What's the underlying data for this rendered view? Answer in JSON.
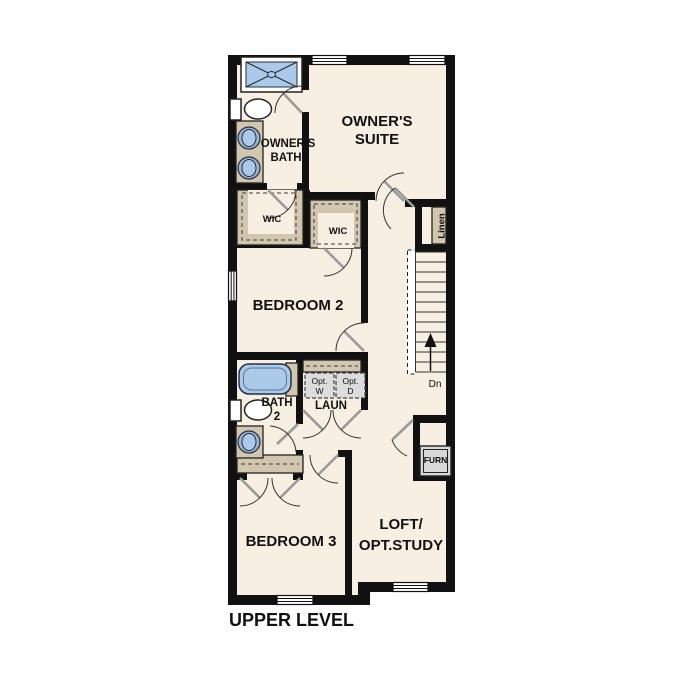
{
  "title": "UPPER LEVEL",
  "colors": {
    "background": "#ffffff",
    "floor": "#f6efe2",
    "walls": "#111111",
    "closet_tan": "#d3c6af",
    "fixture_blue": "#abc9e8",
    "appliance_gray": "#dcdcdc",
    "door_gray": "#9a9a9a"
  },
  "rooms": {
    "owners_suite": {
      "label_line1": "OWNER'S",
      "label_line2": "SUITE"
    },
    "owners_bath": {
      "label_line1": "OWNER'S",
      "label_line2": "BATH"
    },
    "wic_left": {
      "label": "WIC"
    },
    "wic_right": {
      "label": "WIC"
    },
    "linen": {
      "label": "Linen"
    },
    "bedroom2": {
      "label": "BEDROOM 2"
    },
    "bath2": {
      "label_line1": "BATH",
      "label_line2": "2"
    },
    "laundry": {
      "label": "LAUN",
      "washer_line1": "Opt.",
      "washer_line2": "W",
      "dryer_line1": "Opt.",
      "dryer_line2": "D"
    },
    "bedroom3": {
      "label": "BEDROOM 3"
    },
    "loft": {
      "label_line1": "LOFT/",
      "label_line2": "OPT.STUDY"
    },
    "furnace": {
      "label": "FURN"
    }
  },
  "stairs": {
    "direction_label": "Dn"
  },
  "fixtures": [
    "shower",
    "owners-bath-toilet",
    "owners-bath-double-vanity",
    "bath2-tub",
    "bath2-toilet",
    "bath2-vanity",
    "optional-washer",
    "optional-dryer",
    "furnace-unit",
    "stairs-down"
  ]
}
